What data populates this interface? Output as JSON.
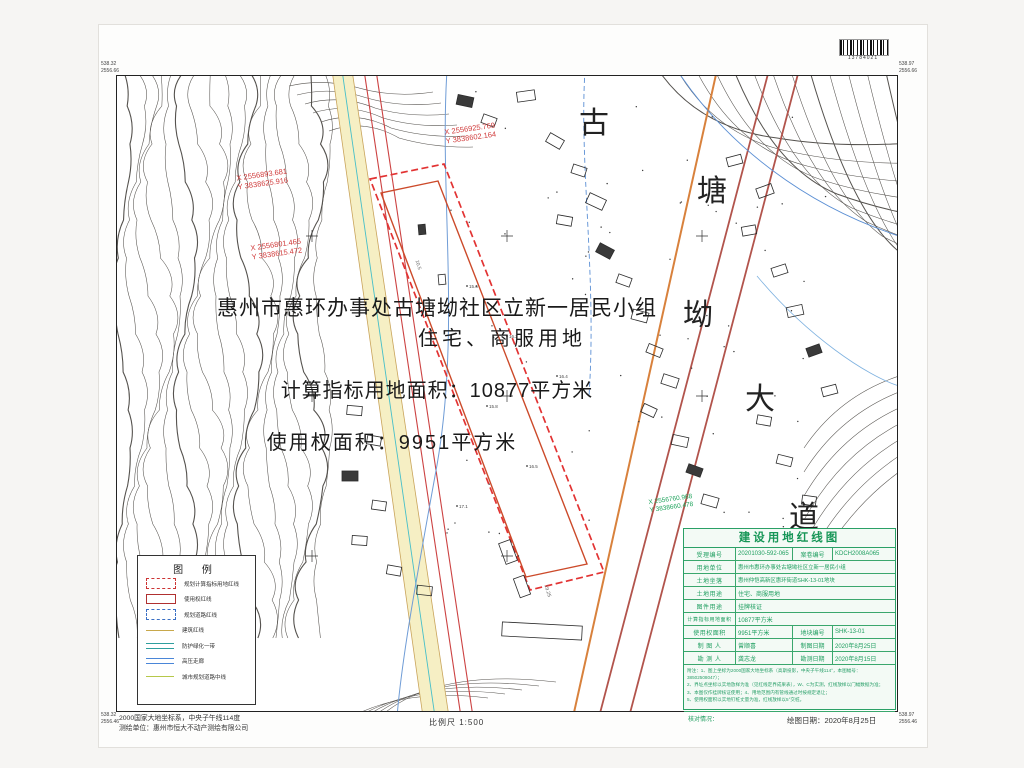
{
  "page": {
    "barcode_number": "13784021",
    "scale_label": "比例尺 1:500",
    "datum_line1": "2000国家大地坐标系，中央子午线114度",
    "datum_line2": "测绘单位：惠州市恒大不动产测绘有限公司",
    "draw_date_label": "绘图日期：2020年8月25日"
  },
  "map": {
    "headline": {
      "line1": "惠州市惠环办事处古塘坳社区立新一居民小组",
      "line2": "住宅、商服用地",
      "line3": "计算指标用地面积：10877平方米",
      "line4": "使用权面积：9951平方米"
    },
    "place_name": [
      "古",
      "塘",
      "坳",
      "大",
      "道"
    ],
    "coord_labels": [
      {
        "x_line": "X 2556925.769",
        "y_line": "Y 3838602.164"
      },
      {
        "x_line": "X 2556893.681",
        "y_line": "Y 3838625.916"
      },
      {
        "x_line": "X 2556801.465",
        "y_line": "Y 3838615.472"
      },
      {
        "x_line": "X 2556760.968",
        "y_line": "Y 3838660.478"
      }
    ],
    "corner_labels": {
      "tl1": "538.32",
      "tl2": "2556.66",
      "tr1": "538.97",
      "tr2": "2556.66",
      "bl1": "538.32",
      "bl2": "2556.46",
      "br1": "538.97",
      "br2": "2556.46"
    },
    "spot_elevations": [
      "15.6",
      "16.2",
      "15.8",
      "16.5",
      "17.1",
      "16.4"
    ],
    "dimension_labels": [
      "19.25",
      "10.5"
    ]
  },
  "legend": {
    "title": "图  例",
    "items": [
      {
        "label": "规划计算指标用地红线"
      },
      {
        "label": "使用权红线"
      },
      {
        "label": "规划道路红线"
      },
      {
        "label": "建筑红线"
      },
      {
        "label": "防护绿化一带"
      },
      {
        "label": "高压走廊"
      },
      {
        "label": "城市规划道路中线"
      }
    ]
  },
  "info_table": {
    "title": "建设用地红线图",
    "r1": {
      "l1": "受理编号",
      "v1": "20201030-592-065",
      "l2": "案卷编号",
      "v2": "KDCH2008A065"
    },
    "r2": {
      "l": "用地单位",
      "v": "惠州市惠环办事处古塘坳社区立新一居民小组"
    },
    "r3": {
      "l": "土地坐落",
      "v": "惠州仲恺高新区惠环街道SHK-13-01地块"
    },
    "r4": {
      "l": "土地用途",
      "v": "住宅、商服用地"
    },
    "r5": {
      "l": "图件用途",
      "v": "挂牌核证"
    },
    "r6": {
      "l": "计算指标用地面积",
      "v": "10877平方米"
    },
    "r7": {
      "l1": "使用权面积",
      "v1": "9951平方米",
      "l2": "地块编号",
      "v2": "SHK-13-01"
    },
    "r8": {
      "l1": "制 图 人",
      "v1": "曾顺喜",
      "l2": "制图日期",
      "v2": "2020年8月25日"
    },
    "r9": {
      "l1": "勘 测 人",
      "v1": "龚志龙",
      "l2": "勘测日期",
      "v2": "2020年8月15日"
    },
    "notes": [
      "附注：1、图上坐标为2000国家大地坐标系（高斯投影，中央子午线114°，本图幅号：38502508047）；",
      "2、界址点坐标以实地放样为准（见红线定界成果表），W、C为实测，红线放样以门幅数据为准；",
      "3、本图仅作挂牌核证使用；4、用地范围内有管线通过时按规定退让；",
      "5、使用权面积以实地钉桩丈量为准，红线放样以5°交桩。"
    ],
    "check_label": "核对情况："
  }
}
